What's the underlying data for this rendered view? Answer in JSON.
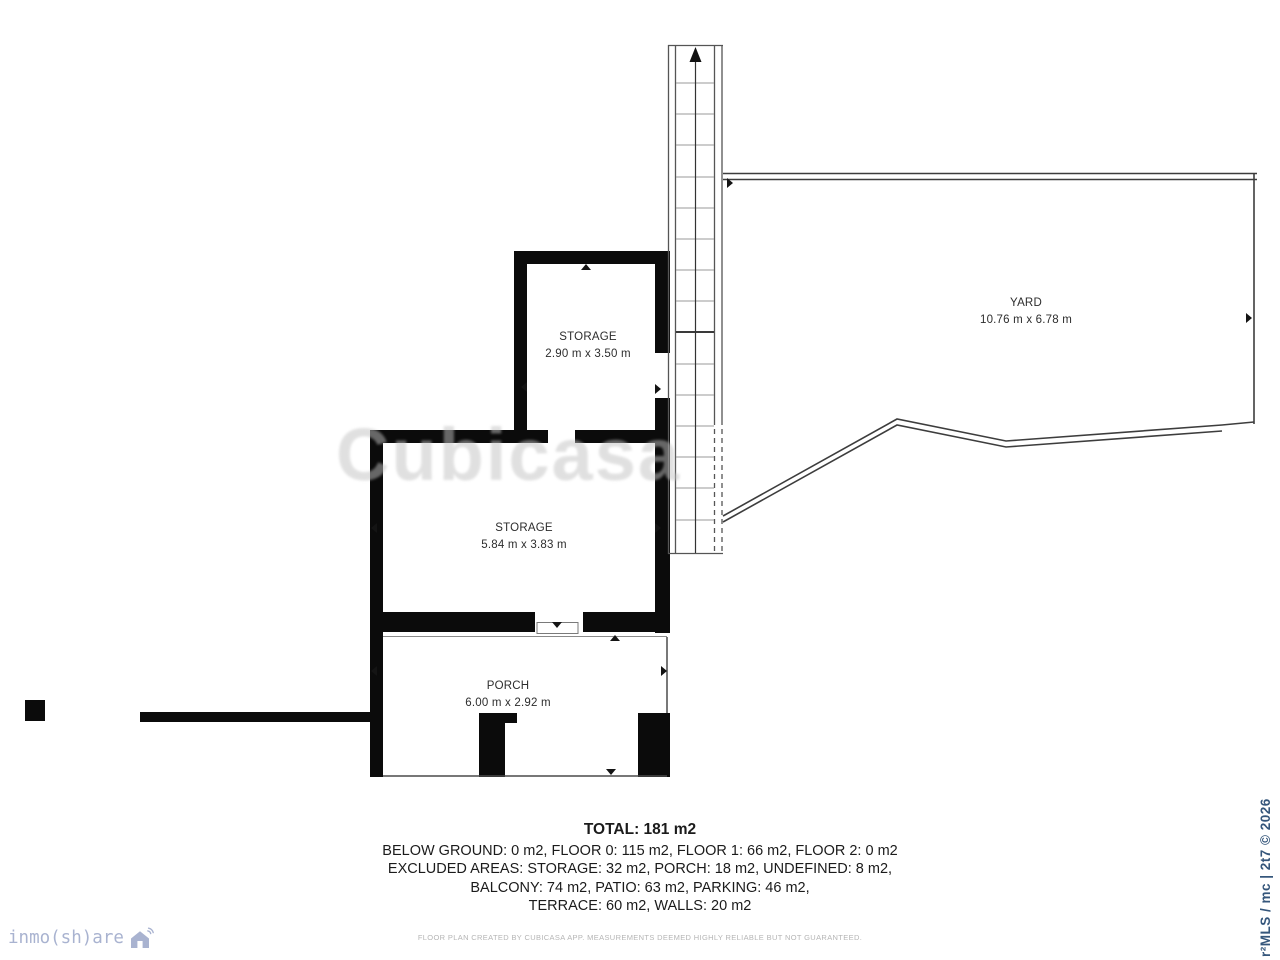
{
  "plan": {
    "rooms": [
      {
        "id": "storage-upper",
        "name": "STORAGE",
        "dims": "2.90 m x 3.50 m"
      },
      {
        "id": "storage-lower",
        "name": "STORAGE",
        "dims": "5.84 m x 3.83 m"
      },
      {
        "id": "porch",
        "name": "PORCH",
        "dims": "6.00 m x 2.92 m"
      },
      {
        "id": "yard",
        "name": "YARD",
        "dims": "10.76 m x 6.78 m"
      }
    ]
  },
  "summary": {
    "total": "TOTAL: 181 m2",
    "lines": [
      "BELOW GROUND: 0 m2, FLOOR 0: 115 m2, FLOOR 1: 66 m2, FLOOR 2: 0 m2",
      "EXCLUDED AREAS: STORAGE: 32 m2, PORCH: 18 m2, UNDEFINED: 8 m2,",
      "BALCONY: 74 m2, PATIO: 63 m2, PARKING: 46 m2,",
      "TERRACE: 60 m2, WALLS: 20 m2"
    ]
  },
  "disclaimer": "FLOOR PLAN CREATED BY CUBICASA APP. MEASUREMENTS DEEMED HIGHLY RELIABLE BUT NOT GUARANTEED.",
  "watermark": "Cubicasa",
  "branding": {
    "logo_text": "inmo(sh)are",
    "side_text": "r²MLS / mc | 2t7 © 2026"
  },
  "colors": {
    "wall": "#0b0b0b",
    "logo": "#a9b3d0",
    "side_text": "#35567b",
    "disclaimer": "#b5b5b5"
  }
}
